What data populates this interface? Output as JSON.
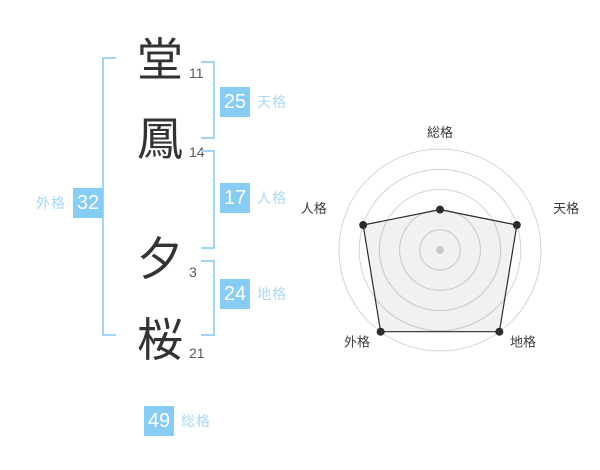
{
  "name": {
    "characters": [
      {
        "char": "堂",
        "strokes": "11"
      },
      {
        "char": "鳳",
        "strokes": "14"
      },
      {
        "char": "夕",
        "strokes": "3"
      },
      {
        "char": "桜",
        "strokes": "21"
      }
    ]
  },
  "kaku": {
    "tenkaku": {
      "label": "天格",
      "value": "25"
    },
    "jinkaku": {
      "label": "人格",
      "value": "17"
    },
    "chikaku": {
      "label": "地格",
      "value": "24"
    },
    "gaikaku": {
      "label": "外格",
      "value": "32"
    },
    "soukaku": {
      "label": "総格",
      "value": "49"
    }
  },
  "colors": {
    "badge_blue": "#87CCF2",
    "label_blue": "#A6D9F5",
    "bracket_blue": "#A0D6F4",
    "kanji_dark": "#333333",
    "stroke_number_gray": "#595959",
    "ring_gray": "#D4D4D4",
    "chart_line": "#2B2B2B",
    "chart_label": "#3A3A3A",
    "center_dot_gray": "#C9C9C9"
  },
  "chart_data": {
    "type": "radar",
    "categories": [
      "総格",
      "天格",
      "地格",
      "外格",
      "人格"
    ],
    "values": [
      40,
      80,
      100,
      100,
      80
    ],
    "max": 100,
    "rings": 5,
    "start_angle_deg": 90,
    "direction": "clockwise",
    "grid": "circular",
    "legend": "none",
    "title": ""
  }
}
